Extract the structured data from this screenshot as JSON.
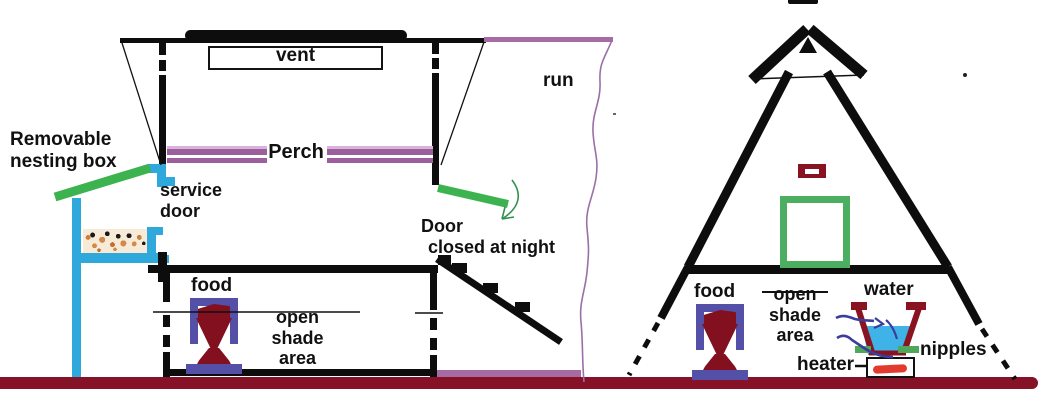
{
  "left_coop": {
    "vent_label": "vent",
    "perch_label": "Perch",
    "run_label": "run",
    "nesting_box_label": {
      "line1": "Removable",
      "line2": "nesting box"
    },
    "service_door_label": {
      "line1": "service",
      "line2": "door"
    },
    "door_note": {
      "line1": "Door",
      "line2": "closed at night"
    },
    "food_label": "food",
    "shade_label": {
      "line1": "open",
      "line2": "shade",
      "line3": "area"
    }
  },
  "a_frame": {
    "food_label": "food",
    "shade_label": {
      "line1": "open",
      "line2": "shade",
      "line3": "area"
    },
    "water_label": "water",
    "nipples_label": "nipples",
    "heater_label": "heater"
  },
  "colors": {
    "ink": "#0d0d0d",
    "ground_maroon": "#851226",
    "dark_red": "#8a1322",
    "feed_red": "#82101e",
    "perch_purple": "#9c5f9e",
    "soft_purple": "#a76ba4",
    "cyan_blue": "#2fa8dc",
    "green": "#3cb34f",
    "door_square_green": "#4bae60",
    "feeder_indigo": "#5450a8",
    "water_blue": "#3fb3e8",
    "wire_navy": "#3a3d9c",
    "heater_red": "#e23b2e",
    "bedding_tan": "#d4894c"
  }
}
